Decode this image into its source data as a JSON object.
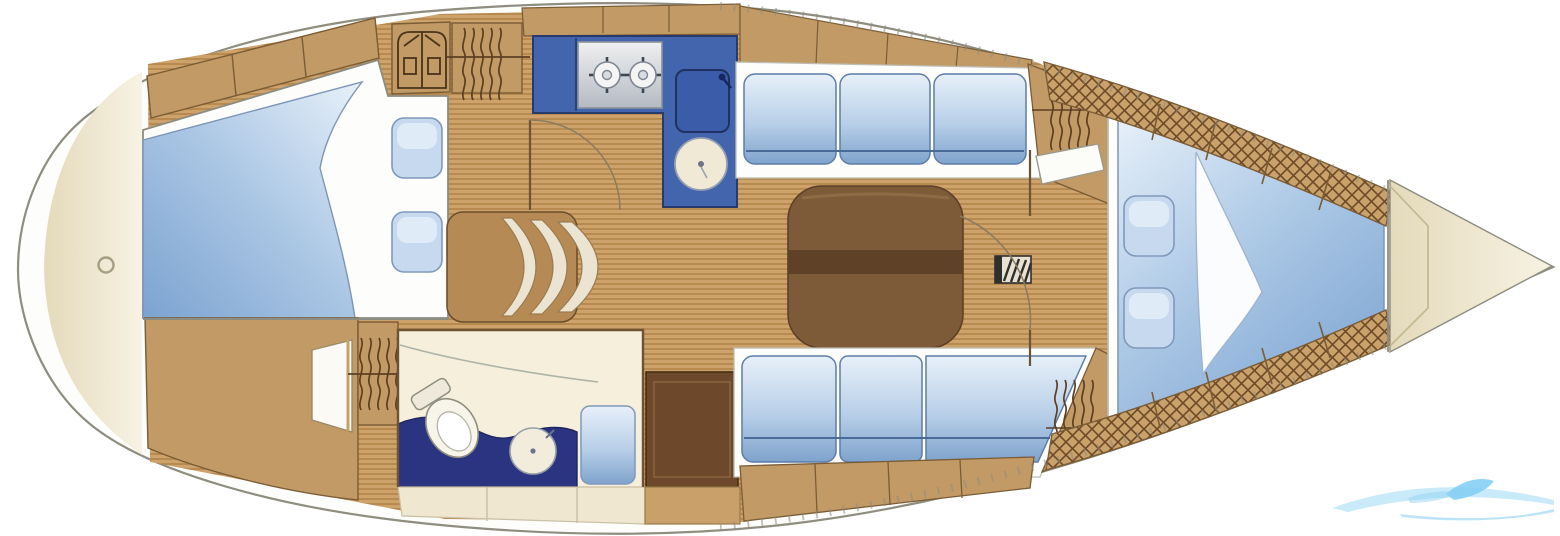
{
  "vessel": {
    "type": "sailing yacht interior floor plan",
    "orientation": "bow to the right, stern rounded at left",
    "visible_text": []
  },
  "compartments": [
    {
      "name": "stern-lazarette",
      "features": [
        "deck-drain-ring"
      ]
    },
    {
      "name": "aft-cabin",
      "features": [
        "athwartships double berth",
        "folded duvet",
        "two pillows",
        "top locker row",
        "hanging locker",
        "shelf locker",
        "cabin door"
      ]
    },
    {
      "name": "head",
      "features": [
        "toilet",
        "round washbasin",
        "navy counter",
        "shower seat",
        "wet locker cabinet"
      ]
    },
    {
      "name": "nav-seat",
      "features": [
        "curved cushion fan"
      ]
    },
    {
      "name": "galley",
      "features": [
        "L-shaped blue counter",
        "two-burner stove",
        "icebox with faucet",
        "round sink"
      ]
    },
    {
      "name": "saloon",
      "features": [
        "port settee 3 cushions",
        "starboard settee 3 cushions",
        "brown folding table",
        "mast step",
        "door swing arcs"
      ]
    },
    {
      "name": "forward-cabin",
      "features": [
        "v-berth",
        "folded sheet",
        "two pillows",
        "cane-lattice locker strips"
      ]
    },
    {
      "name": "anchor-locker",
      "features": [
        "chamfered bow locker"
      ]
    }
  ],
  "icons": [
    "hanging-locker-icon",
    "shelf-waves-icon",
    "cane-lattice-icon",
    "stove-burner-icon",
    "sink-icon",
    "toilet-icon",
    "mast-step-icon",
    "drain-ring-icon",
    "door-swing-icon",
    "wave-swoosh-watermark"
  ],
  "colors": {
    "background": "#ffffff",
    "hull_outline": "#8e8d7f",
    "deck": "#fdfdfc",
    "floor_plank_base": "#cda26b",
    "floor_plank_stripe": "#b28449",
    "joinery_tan": "#c29a66",
    "joinery_outline": "#7a5c35",
    "stern_beige": "#e9e0c3",
    "stern_beige_light": "#f6f1e1",
    "cream_panel": "#efe7d0",
    "galley_blue": "#4265ad",
    "galley_blue_dark": "#263a6b",
    "counter_navy": "#2a3480",
    "cushion_light": "#e3eef8",
    "cushion_deep": "#7fa3cd",
    "cushion_outline": "#5d7da6",
    "mattress_white": "#fdfdfc",
    "bed_blue_deep": "#7ca3d1",
    "pillow_fill": "#c6d9ef",
    "pillow_outline": "#8099bb",
    "table_top": "#7d5b39",
    "table_band": "#5e4126",
    "cabinet_dark": "#6e482a",
    "steel_light": "#eceded",
    "steel_dark": "#b4bac3",
    "fixture_cream": "#f1ecdc",
    "fixture_outline": "#98a0a8",
    "icon_brown": "#5d3f20",
    "wall_line": "#6d5233",
    "watermark_light": "#bfe6f8",
    "watermark_mid": "#7fcdf3"
  },
  "watermark": {
    "style": "wave-swoosh",
    "text_legible": false
  }
}
